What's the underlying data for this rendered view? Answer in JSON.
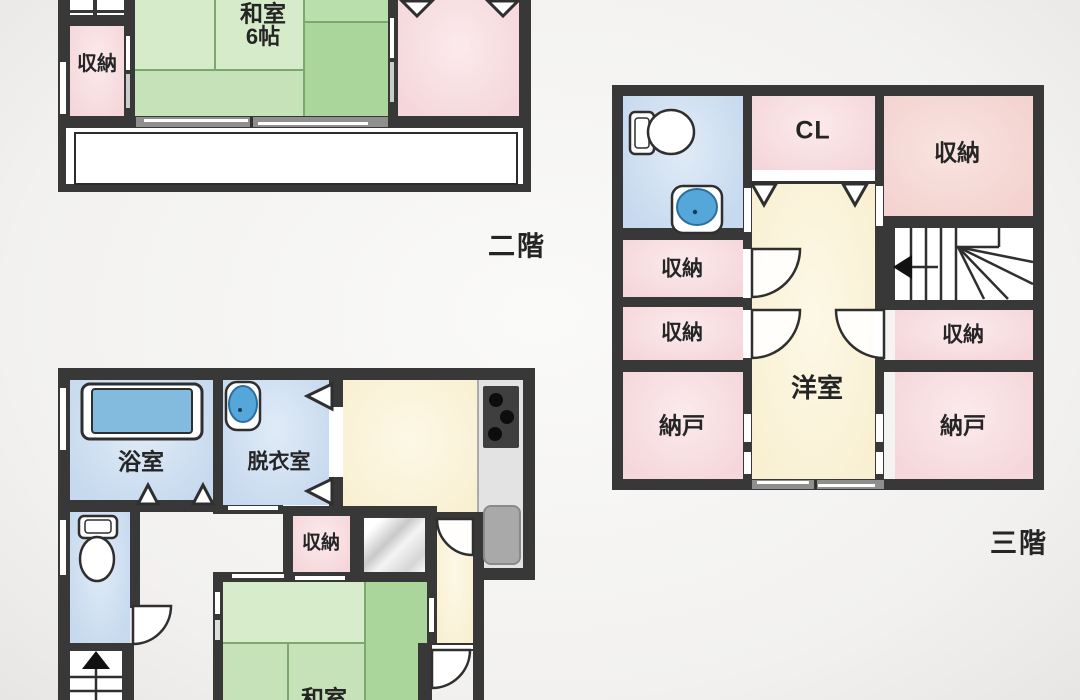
{
  "floor2": {
    "floor_label": "二階",
    "storage": "収納",
    "washitsu_name": "和室",
    "washitsu_size": "6帖"
  },
  "floor3": {
    "floor_label": "三階",
    "closet_label": "CL",
    "storage_top_right": "収納",
    "storage_left_upper": "収納",
    "storage_left_lower": "収納",
    "storage_right": "収納",
    "nando_left": "納戸",
    "nando_right": "納戸",
    "western_room": "洋室"
  },
  "floor1": {
    "bathroom": "浴室",
    "dressing_room": "脱衣室",
    "storage": "収納",
    "japanese_room": "和室"
  },
  "colors": {
    "wall": "#383838",
    "pink_room": "#f5d7db",
    "green_room": "#c6e2b9",
    "blue_room": "#c6d9ee",
    "cream_room": "#f9f0d2",
    "tub": "#82bbdd",
    "sink": "#55a7d9"
  }
}
